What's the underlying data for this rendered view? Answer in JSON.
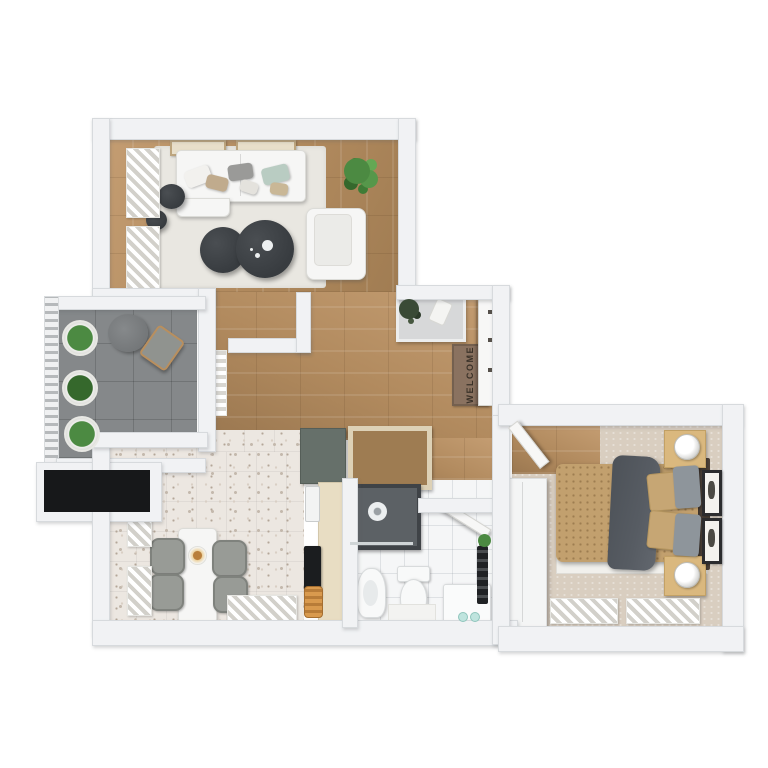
{
  "title": "3D apartment floor plan rendering",
  "mat": {
    "text": "WELCOME"
  },
  "colors": {
    "wall": "#f1f2f4",
    "wall_shadow": "#d7dadd",
    "wood_floor": "#b18a5e",
    "wood_floor_light": "#c49d72",
    "rug": "#e9e7e1",
    "balcony_tile": "#85888a",
    "terrazzo": "#ece7e1",
    "bath_tile": "#f5f6f7",
    "carpet": "#d9cec0",
    "sofa_white": "#f6f6f5",
    "table_dark": "#383c40",
    "plant_green": "#4c8a42",
    "plant_green_dark": "#35682c",
    "counter_green": "#66706a",
    "cabinet_beige": "#e8ddc3",
    "mat_brown": "#8a7260",
    "mat_text": "#3b3229",
    "bed_tan": "#c2a06e",
    "throw_gray": "#575c63",
    "pillow_gray": "#8e959b",
    "nightstand_wood": "#dab87e",
    "oven_black": "#1b1d1f",
    "window_black": "#17181a",
    "basket_orange": "#d99a4e"
  }
}
